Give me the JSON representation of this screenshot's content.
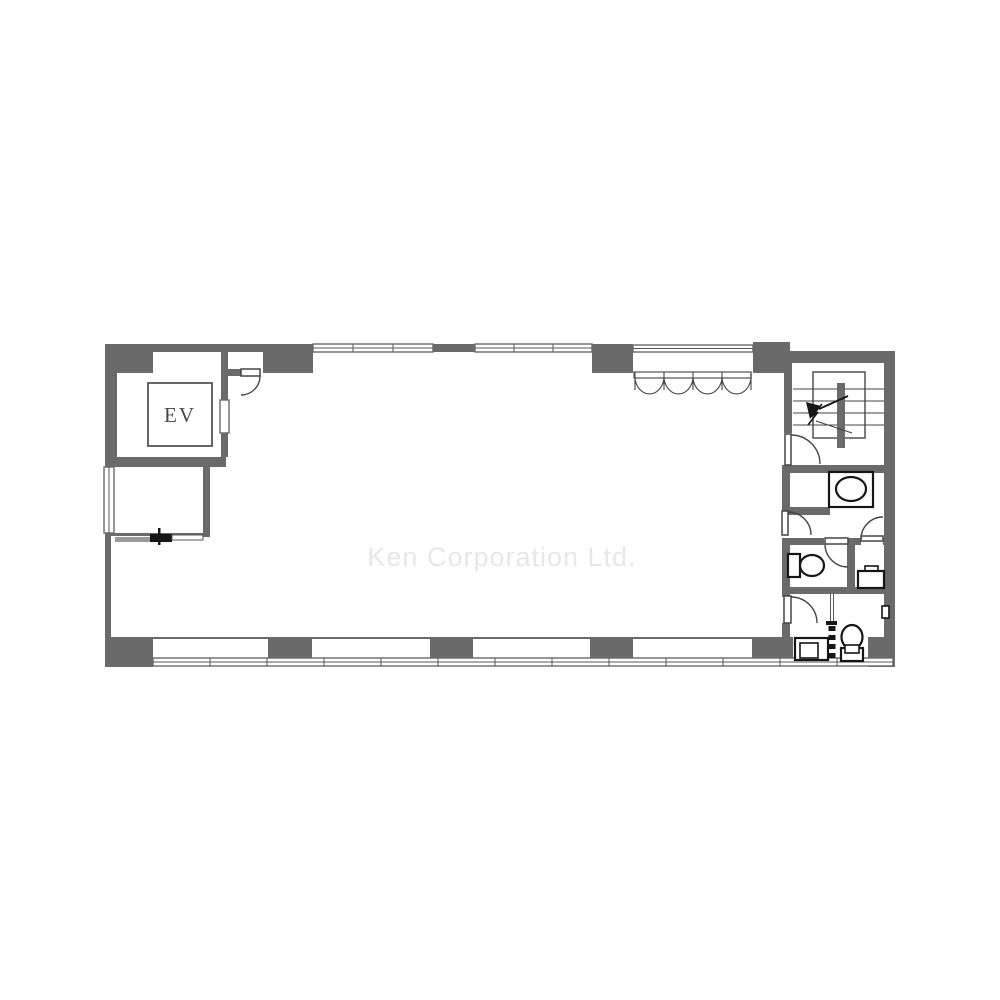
{
  "palette": {
    "wall": "#6a6a6a",
    "line": "#454545",
    "fixture": "#161616",
    "watermark_color": "#e7e7e7",
    "label_color": "#4a4a4a",
    "background": "#ffffff"
  },
  "plan": {
    "elevator_label": "EV",
    "watermark_text": "Ken Corporation Ltd."
  }
}
